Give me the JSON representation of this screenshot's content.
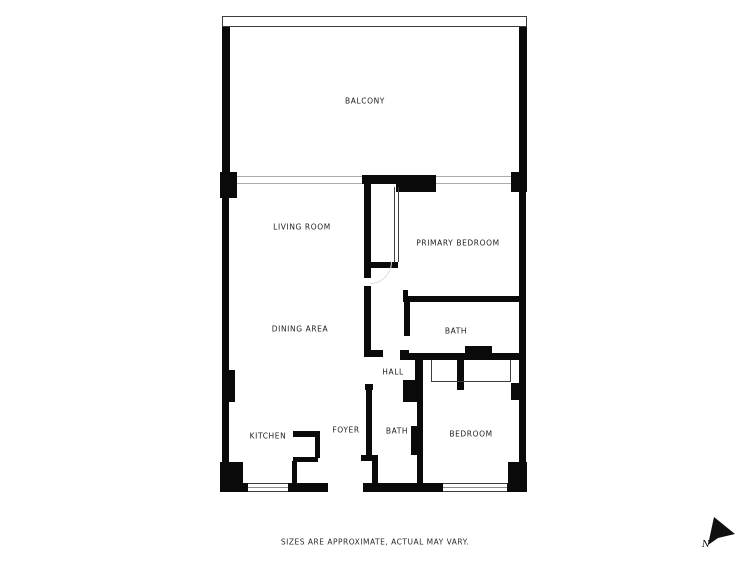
{
  "rooms": [
    {
      "id": "balcony",
      "label": "BALCONY"
    },
    {
      "id": "living-room",
      "label": "LIVING ROOM"
    },
    {
      "id": "primary-bedroom",
      "label": "PRIMARY BEDROOM"
    },
    {
      "id": "dining-area",
      "label": "DINING AREA"
    },
    {
      "id": "bath-upper",
      "label": "BATH"
    },
    {
      "id": "hall",
      "label": "HALL"
    },
    {
      "id": "kitchen",
      "label": "KITCHEN"
    },
    {
      "id": "foyer",
      "label": "FOYER"
    },
    {
      "id": "bath-lower",
      "label": "BATH"
    },
    {
      "id": "bedroom",
      "label": "BEDROOM"
    }
  ],
  "disclaimer": "SIZES ARE APPROXIMATE, ACTUAL MAY VARY.",
  "compass": {
    "north_label": "N"
  },
  "colors": {
    "wall": "#0a0a0a",
    "background": "#ffffff",
    "thin_line": "#8c8c8c"
  }
}
